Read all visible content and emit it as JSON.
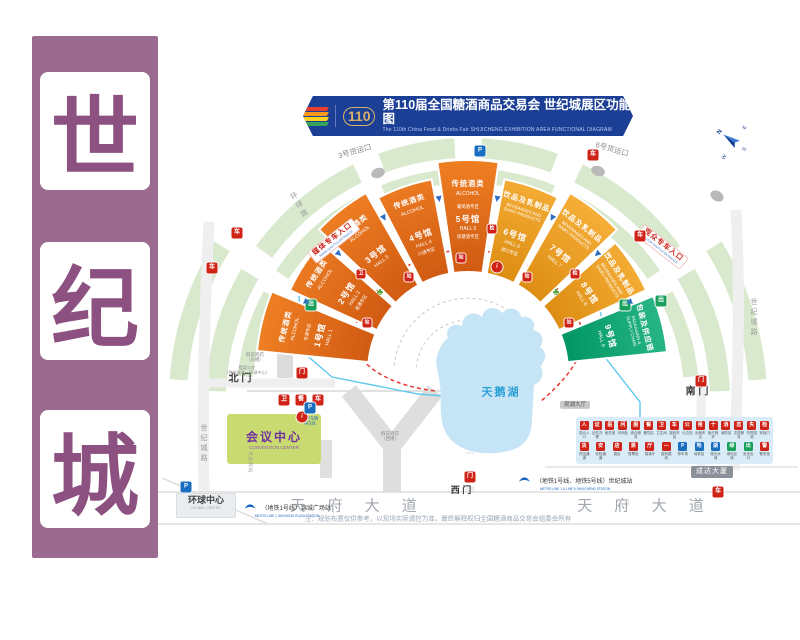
{
  "side_banner": {
    "bg": "#9a6b8f",
    "char_color": "#8c5180",
    "chars": [
      "世",
      "纪",
      "城"
    ]
  },
  "header": {
    "bg": "#1c3f96",
    "logo_text": "110",
    "title": "第110届全国糖酒商品交易会 世纪城展区功能图",
    "subtitle": "The 110th China Food & Drinks Fair SHIJICHENG EXHIBITION AREA FUNCTIONAL DIAGRAM",
    "logo_stripe_colors": [
      "#e8402d",
      "#f59a1d",
      "#ffd21f",
      "#35a45a"
    ]
  },
  "compass": {
    "n": "N",
    "e": "E",
    "s": "S",
    "w": "W"
  },
  "roads": {
    "tianfu_left": "天 府 大 道",
    "tianfu_right": "天 府 大 道",
    "shijicheng_left": "世纪城路",
    "shijicheng_right": "世纪城路",
    "huanqiu": "环球路",
    "cargo_gate_3": "3号货运口",
    "cargo_gate_6": "6号货运口"
  },
  "gates": {
    "north": "北 门",
    "south": "南 门",
    "west": "西 门"
  },
  "lake": {
    "name": "天鹅湖",
    "color": "#c5e4f5"
  },
  "halls": [
    {
      "name": "1号馆",
      "name_en": "HALL 1",
      "category": "传统酒类",
      "category_en": "ALCOHOL",
      "zone_above": "名酒专区",
      "zone_below": "",
      "color": "#e2611b"
    },
    {
      "name": "2号馆",
      "name_en": "HALL 2",
      "category": "传统酒类",
      "category_en": "ALCOHOL",
      "zone_above": "",
      "zone_below": "老酒专区",
      "color": "#e2611b"
    },
    {
      "name": "3号馆",
      "name_en": "HALL 3",
      "category": "传统酒类",
      "category_en": "ALCOHOL",
      "zone_above": "",
      "zone_below": "",
      "color": "#e2611b"
    },
    {
      "name": "4号馆",
      "name_en": "HALL 4",
      "category": "传统酒类",
      "category_en": "ALCOHOL",
      "zone_above": "",
      "zone_below": "川酒专区",
      "color": "#e2611b"
    },
    {
      "name": "5号馆",
      "name_en": "HALL 5",
      "category": "传统酒类",
      "category_en": "ALCOHOL",
      "zone_above": "葡萄酒专区",
      "zone_below": "保健酒专区",
      "color": "#e2611b"
    },
    {
      "name": "6号馆",
      "name_en": "HALL 6",
      "category": "饮品及乳制品",
      "category_en": "BEVERAGES AND DAIRY PRODUCTS",
      "zone_above": "",
      "zone_below": "进口专区",
      "color": "#f09c23"
    },
    {
      "name": "7号馆",
      "name_en": "HALL 7",
      "category": "饮品及乳制品",
      "category_en": "BEVERAGES AND DAIRY PRODUCTS",
      "zone_above": "",
      "zone_below": "",
      "color": "#f09c23"
    },
    {
      "name": "8号馆",
      "name_en": "HALL 8",
      "category": "饮品及乳制品",
      "category_en": "BEVERAGES AND DAIRY PRODUCTS",
      "zone_above": "",
      "zone_below": "",
      "color": "#f09c23"
    },
    {
      "name": "9号馆",
      "name_en": "HALL 9",
      "category": "包装及供应链",
      "category_en": "PACKAGING & SUPPLY CHAIN",
      "zone_above": "",
      "zone_below": "",
      "color": "#00a578"
    }
  ],
  "places": {
    "convention_center": {
      "name": "会议中心",
      "en": "CONVENTION CENTER",
      "bg": "#c9da70",
      "color": "#7030a0"
    },
    "holiday_inn_east_l1": "假日酒店",
    "holiday_inn_east_l2": "（东楼）",
    "holiday_inn_west_l1": "假日酒店",
    "holiday_inn_west_l2": "（西楼）",
    "intercontinental": "洲际酒店",
    "guanhu_hall": "观湖大厅",
    "chengda_building": "成达大厦",
    "global_center": {
      "name": "环球中心",
      "en": "GLOBAL CENTER"
    },
    "shuttle_bus_l1": "摆渡公交",
    "shuttle_bus_l2": "（世纪城北—环球中心）",
    "staff_parking_l1": "工作车辆",
    "staff_parking_l2": "停车区"
  },
  "entrances": {
    "media": {
      "label": "媒体专车入口",
      "en": "MEDIA SHUTTLE ENTRANCE"
    },
    "visitor": {
      "label": "观众专车入口",
      "en": "VISITOR SHUTTLE ENTRANCE"
    }
  },
  "metro": {
    "southwest": {
      "label": "（地铁1号线）锦城广场站",
      "en": "METRO LINE 1  JINCHENG PLAZA STATION"
    },
    "southeast": {
      "label": "（地铁1号线、地铁5号线）世纪城站",
      "en": "METRO LINE 1 & LINE 5  SHIJICHENG STATION"
    }
  },
  "legend": {
    "rows": [
      [
        {
          "label": "观众入口",
          "glyph": "人",
          "color": "#cf2318"
        },
        {
          "label": "证件办理",
          "glyph": "证",
          "color": "#cf2318"
        },
        {
          "label": "医务室",
          "glyph": "医",
          "color": "#cf2318"
        },
        {
          "label": "问询处",
          "glyph": "问",
          "color": "#cf2318"
        },
        {
          "label": "综合服务",
          "glyph": "服",
          "color": "#cf2318"
        },
        {
          "label": "餐饮区",
          "glyph": "餐",
          "color": "#cf2318"
        },
        {
          "label": "卫生间",
          "glyph": "卫",
          "color": "#cf2318"
        },
        {
          "label": "接驳车站",
          "glyph": "车",
          "color": "#cf2318"
        },
        {
          "label": "公交站",
          "glyph": "公",
          "color": "#cf2318"
        },
        {
          "label": "出租车点",
          "glyph": "租",
          "color": "#cf2318"
        },
        {
          "label": "医疗救护",
          "glyph": "十",
          "color": "#cf2318"
        },
        {
          "label": "消防站",
          "glyph": "消",
          "color": "#cf2318"
        },
        {
          "label": "志愿服务",
          "glyph": "志",
          "color": "#cf2318"
        },
        {
          "label": "失物招领",
          "glyph": "失",
          "color": "#cf2318"
        },
        {
          "label": "安检口",
          "glyph": "检",
          "color": "#cf2318"
        }
      ],
      [
        {
          "label": "货运通道",
          "glyph": "货",
          "color": "#cf2318"
        },
        {
          "label": "安检通道",
          "glyph": "安",
          "color": "#cf2318"
        },
        {
          "label": "酒店",
          "glyph": "店",
          "color": "#cf2318"
        },
        {
          "label": "售票处",
          "glyph": "票",
          "color": "#cf2318"
        },
        {
          "label": "观演厅",
          "glyph": "厅",
          "color": "#cf2318"
        },
        {
          "label": "接驳路线",
          "glyph": "⋯",
          "color": "#cf2318"
        },
        {
          "label": "停车场",
          "glyph": "P",
          "color": "#1a6ec0"
        },
        {
          "label": "地铁站",
          "glyph": "地",
          "color": "#1a6ec0"
        },
        {
          "label": "观光水域",
          "glyph": "湖",
          "color": "#1a6ec0"
        },
        {
          "label": "绿化区域",
          "glyph": "绿",
          "color": "#19a05b"
        },
        {
          "label": "安全出口",
          "glyph": "出",
          "color": "#19a05b"
        },
        {
          "label": "警务室",
          "glyph": "警",
          "color": "#cf2318"
        }
      ]
    ]
  },
  "icon_defs": {
    "shuttle": {
      "glyph": "车",
      "color": "#cf2318",
      "name": "shuttle-bus-icon"
    },
    "gate": {
      "glyph": "门",
      "color": "#cf2318",
      "name": "gate-icon"
    },
    "wc": {
      "glyph": "卫",
      "color": "#cf2318",
      "name": "restroom-icon"
    },
    "food": {
      "glyph": "餐",
      "color": "#cf2318",
      "name": "dining-icon"
    },
    "security": {
      "glyph": "检",
      "color": "#cf2318",
      "name": "security-check-icon"
    },
    "info": {
      "glyph": "i",
      "color": "#cf2318",
      "name": "information-icon"
    },
    "parking": {
      "glyph": "P",
      "color": "#1a6ec0",
      "name": "parking-icon"
    },
    "exit": {
      "glyph": "出",
      "color": "#19a05b",
      "name": "exit-icon"
    },
    "stop": {
      "glyph": "站",
      "color": "#cf2318",
      "name": "shuttle-stop-icon"
    },
    "tree": {
      "glyph": "♣",
      "color": "#57a33b",
      "name": "tree-icon"
    },
    "arrow": {
      "glyph": "▶",
      "color": "#2f6fc4",
      "name": "direction-arrow-icon"
    }
  },
  "note": "注：规划布置仅供参考，以现场实际调控为准，最终解释权归全国糖酒商品交易会组委会所有"
}
